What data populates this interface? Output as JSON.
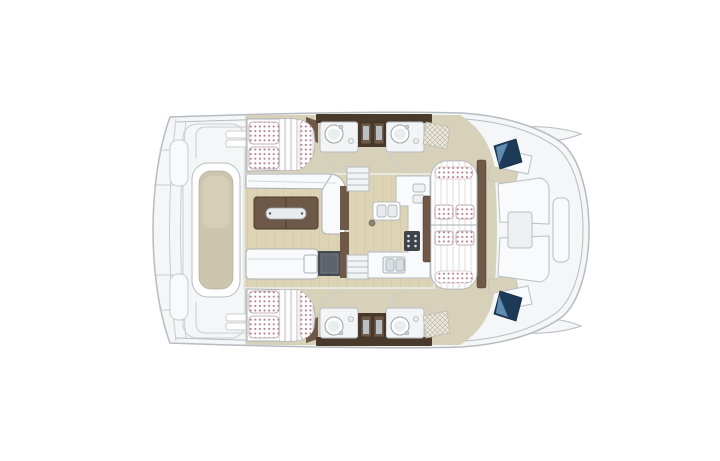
{
  "page": {
    "background": "#ffffff"
  },
  "colors": {
    "hull": "#f4f6f7",
    "outline": "#b6bcc2",
    "line_soft": "#c9cdd1",
    "deck": "#d8d1ba",
    "deck_dark": "#cdc5ad",
    "wood": "#ddd4b6",
    "wood_grain": "#cfc5a5",
    "furniture": "#f8fafb",
    "walnut_dark": "#4a3a2c",
    "walnut": "#6e5948",
    "cushion_dot": "#b06b7d",
    "stripe": "#d9d7dc",
    "navy": "#1d3b58",
    "sky": "#6d9bc0",
    "appliance": "#5d646b",
    "appliance_dark": "#464c52",
    "steel": "#9aa2a8",
    "sink_fill": "#e8edf0",
    "hatch_bg": "#eceadf",
    "hatch_line": "#b4ae9e"
  },
  "diagram": {
    "type": "floor-plan",
    "subject": "catamaran yacht interior layout, top view, bow to the right",
    "regions": [
      "stern-swim-platform",
      "aft-platform-table",
      "upper-cabin-bed",
      "lower-cabin-bed",
      "salon-sofa",
      "salon-table",
      "salon-bench",
      "refrigerator",
      "galley-counter",
      "galley-stove",
      "galley-sink",
      "companionway-stairs-upper",
      "companionway-stairs-lower",
      "bathroom-upper-left",
      "bathroom-upper-right",
      "bathroom-lower-left",
      "bathroom-lower-right",
      "forward-cockpit-lounge",
      "bow-sunpads",
      "bow-hatch-upper",
      "bow-hatch-lower"
    ]
  }
}
